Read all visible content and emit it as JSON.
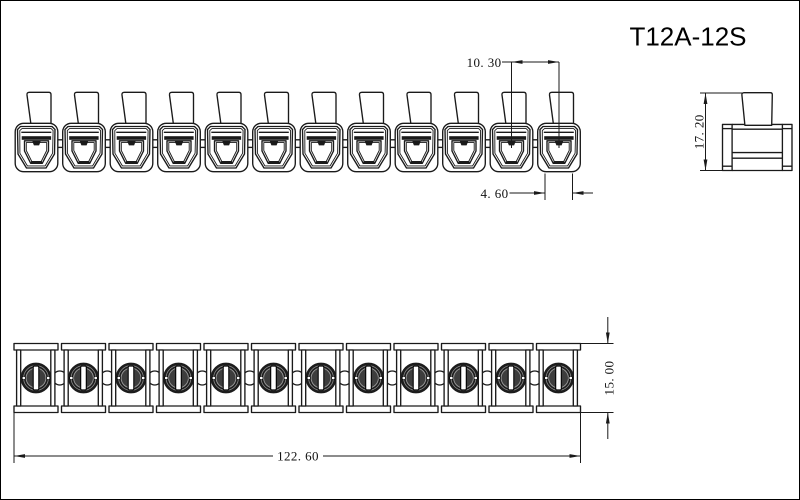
{
  "title": "T12A-12S",
  "part": {
    "terminal_count": 12
  },
  "colors": {
    "line": "#1a1a1a",
    "background": "#ffffff",
    "screw_dark": "#1d1d1d",
    "screw_inner": "#3d3d3d"
  },
  "dimensions": {
    "pitch": "10. 30",
    "opening_width": "4. 60",
    "height": "17. 20",
    "depth": "15. 00",
    "total_length": "122. 60"
  }
}
